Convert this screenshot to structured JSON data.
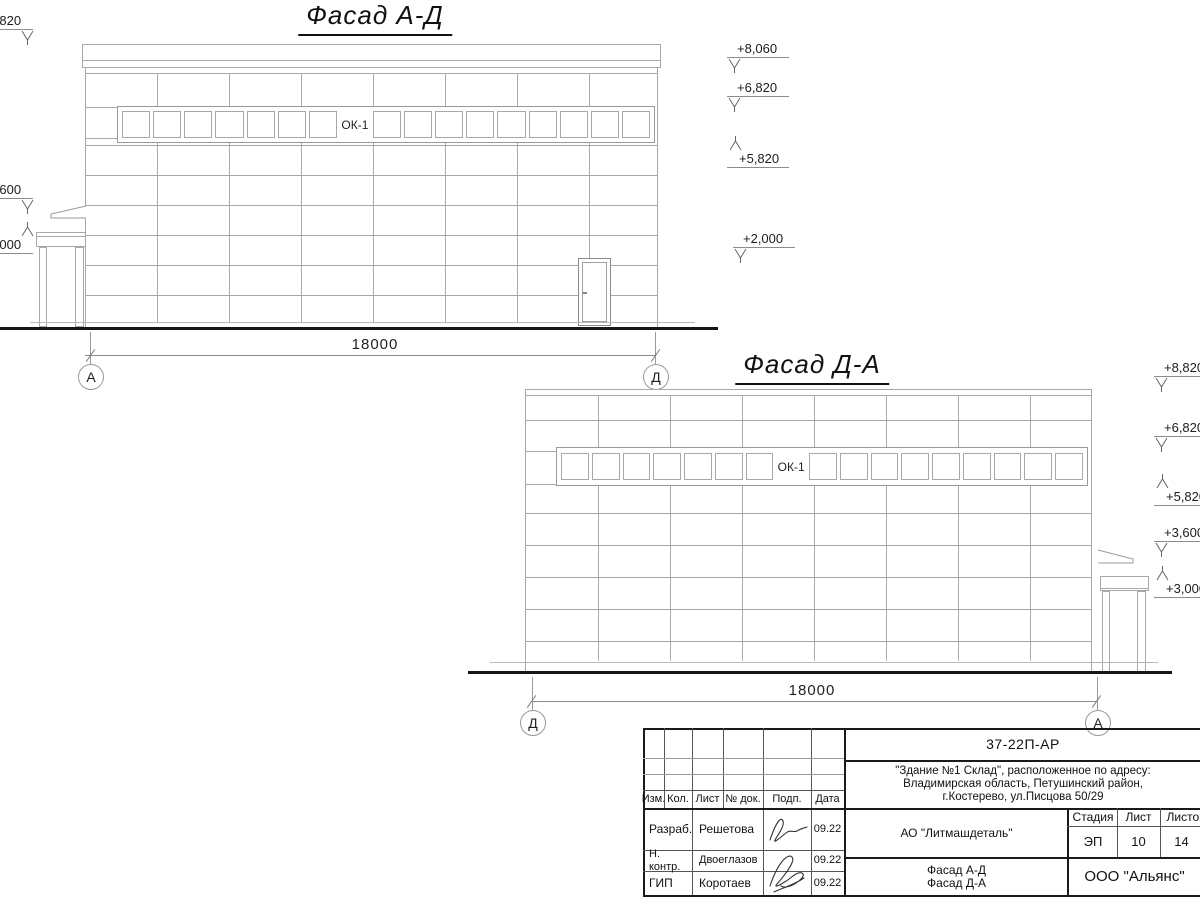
{
  "colors": {
    "line": "#a8a8a8",
    "dark_line": "#1a1a1a",
    "ground": "#161616",
    "text": "#1d1d1d"
  },
  "facade_ad": {
    "title": "Фасад А-Д",
    "dimension": "18000",
    "axis_left": "А",
    "axis_right": "Д",
    "window_band": {
      "label": "ОК-1",
      "panes_before": 7,
      "panes_after": 9
    },
    "elevations_right": [
      {
        "value": "+8,060",
        "dir": "down"
      },
      {
        "value": "+6,820",
        "dir": "down"
      },
      {
        "value": "+5,820",
        "dir": "up"
      },
      {
        "value": "+2,000",
        "dir": "down"
      }
    ],
    "elevations_left": [
      {
        "value": "+8,820",
        "dir": "down"
      },
      {
        "value": "+3,600",
        "dir": "down"
      },
      {
        "value": "+3,000",
        "dir": "up"
      }
    ]
  },
  "facade_da": {
    "title": "Фасад Д-А",
    "dimension": "18000",
    "axis_left": "Д",
    "axis_right": "А",
    "window_band": {
      "label": "ОК-1",
      "panes_before": 7,
      "panes_after": 9
    },
    "elevations_right": [
      {
        "value": "+8,820",
        "dir": "down"
      },
      {
        "value": "+6,820",
        "dir": "down"
      },
      {
        "value": "+5,820",
        "dir": "up"
      },
      {
        "value": "+3,600",
        "dir": "down"
      },
      {
        "value": "+3,000",
        "dir": "up"
      }
    ]
  },
  "title_block": {
    "doc_number": "37-22П-АР",
    "object_lines": [
      "\"Здание №1 Склад\", расположенное по адресу:",
      "Владимирская область, Петушинский район,",
      "г.Костерево, ул.Писцова 50/29"
    ],
    "headers": {
      "izm": "Изм.",
      "kol": "Кол.",
      "list": "Лист",
      "doc": "№ док.",
      "podp": "Подп.",
      "data": "Дата"
    },
    "rows": [
      {
        "role": "Разраб.",
        "name": "Решетова",
        "date": "09.22"
      },
      {
        "role": "Н. контр.",
        "name": "Двоеглазов",
        "date": "09.22"
      },
      {
        "role": "ГИП",
        "name": "Коротаев",
        "date": "09.22"
      }
    ],
    "stage": {
      "label": "Стадия",
      "value": "ЭП"
    },
    "sheet": {
      "label": "Лист",
      "value": "10"
    },
    "sheets": {
      "label": "Листов",
      "value": "14"
    },
    "company": "АО \"Литмашдеталь\"",
    "drawing_titles": [
      "Фасад А-Д",
      "Фасад Д-А"
    ],
    "organization": "ООО \"Альянс\""
  }
}
